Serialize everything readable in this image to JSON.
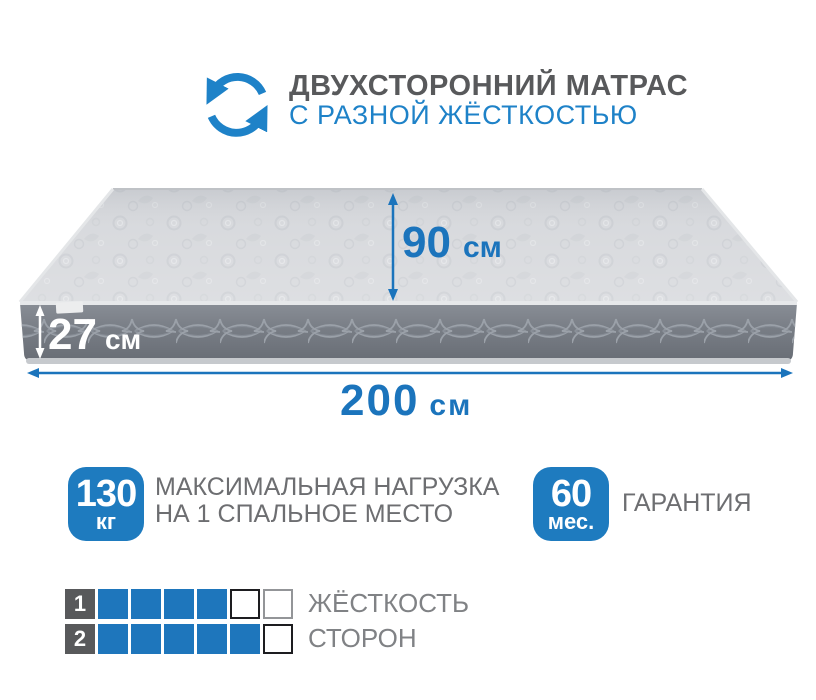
{
  "header": {
    "title": "ДВУХСТОРОННИЙ МАТРАС",
    "subtitle": "С РАЗНОЙ ЖЁСТКОСТЬЮ",
    "icon": "rotate-arrows-icon"
  },
  "dimensions": {
    "depth": {
      "value": "90",
      "unit": "см"
    },
    "height": {
      "value": "27",
      "unit": "см"
    },
    "length": {
      "value": "200",
      "unit": "см"
    }
  },
  "badges": {
    "max_load": {
      "value": "130",
      "unit": "кг",
      "label_line1": "МАКСИМАЛЬНАЯ НАГРУЗКА",
      "label_line2": "НА 1 СПАЛЬНОЕ МЕСТО"
    },
    "warranty": {
      "value": "60",
      "unit": "мес.",
      "label": "ГАРАНТИЯ"
    }
  },
  "firmness": {
    "label_line1": "ЖЁСТКОСТЬ",
    "label_line2": "СТОРОН",
    "rows": [
      {
        "number": "1",
        "cells": [
          "filled",
          "filled",
          "filled",
          "filled",
          "empty-dark",
          "empty-light"
        ]
      },
      {
        "number": "2",
        "cells": [
          "filled",
          "filled",
          "filled",
          "filled",
          "filled",
          "empty-dark"
        ]
      }
    ]
  },
  "colors": {
    "blue": "#1e76bc",
    "accent_blue": "#1e82c8",
    "dark_text": "#58595b",
    "gray_text": "#6d6e71",
    "scale_label_gray": "#808285",
    "mattress_top": "#d4d6da",
    "mattress_side": "#767b83"
  }
}
